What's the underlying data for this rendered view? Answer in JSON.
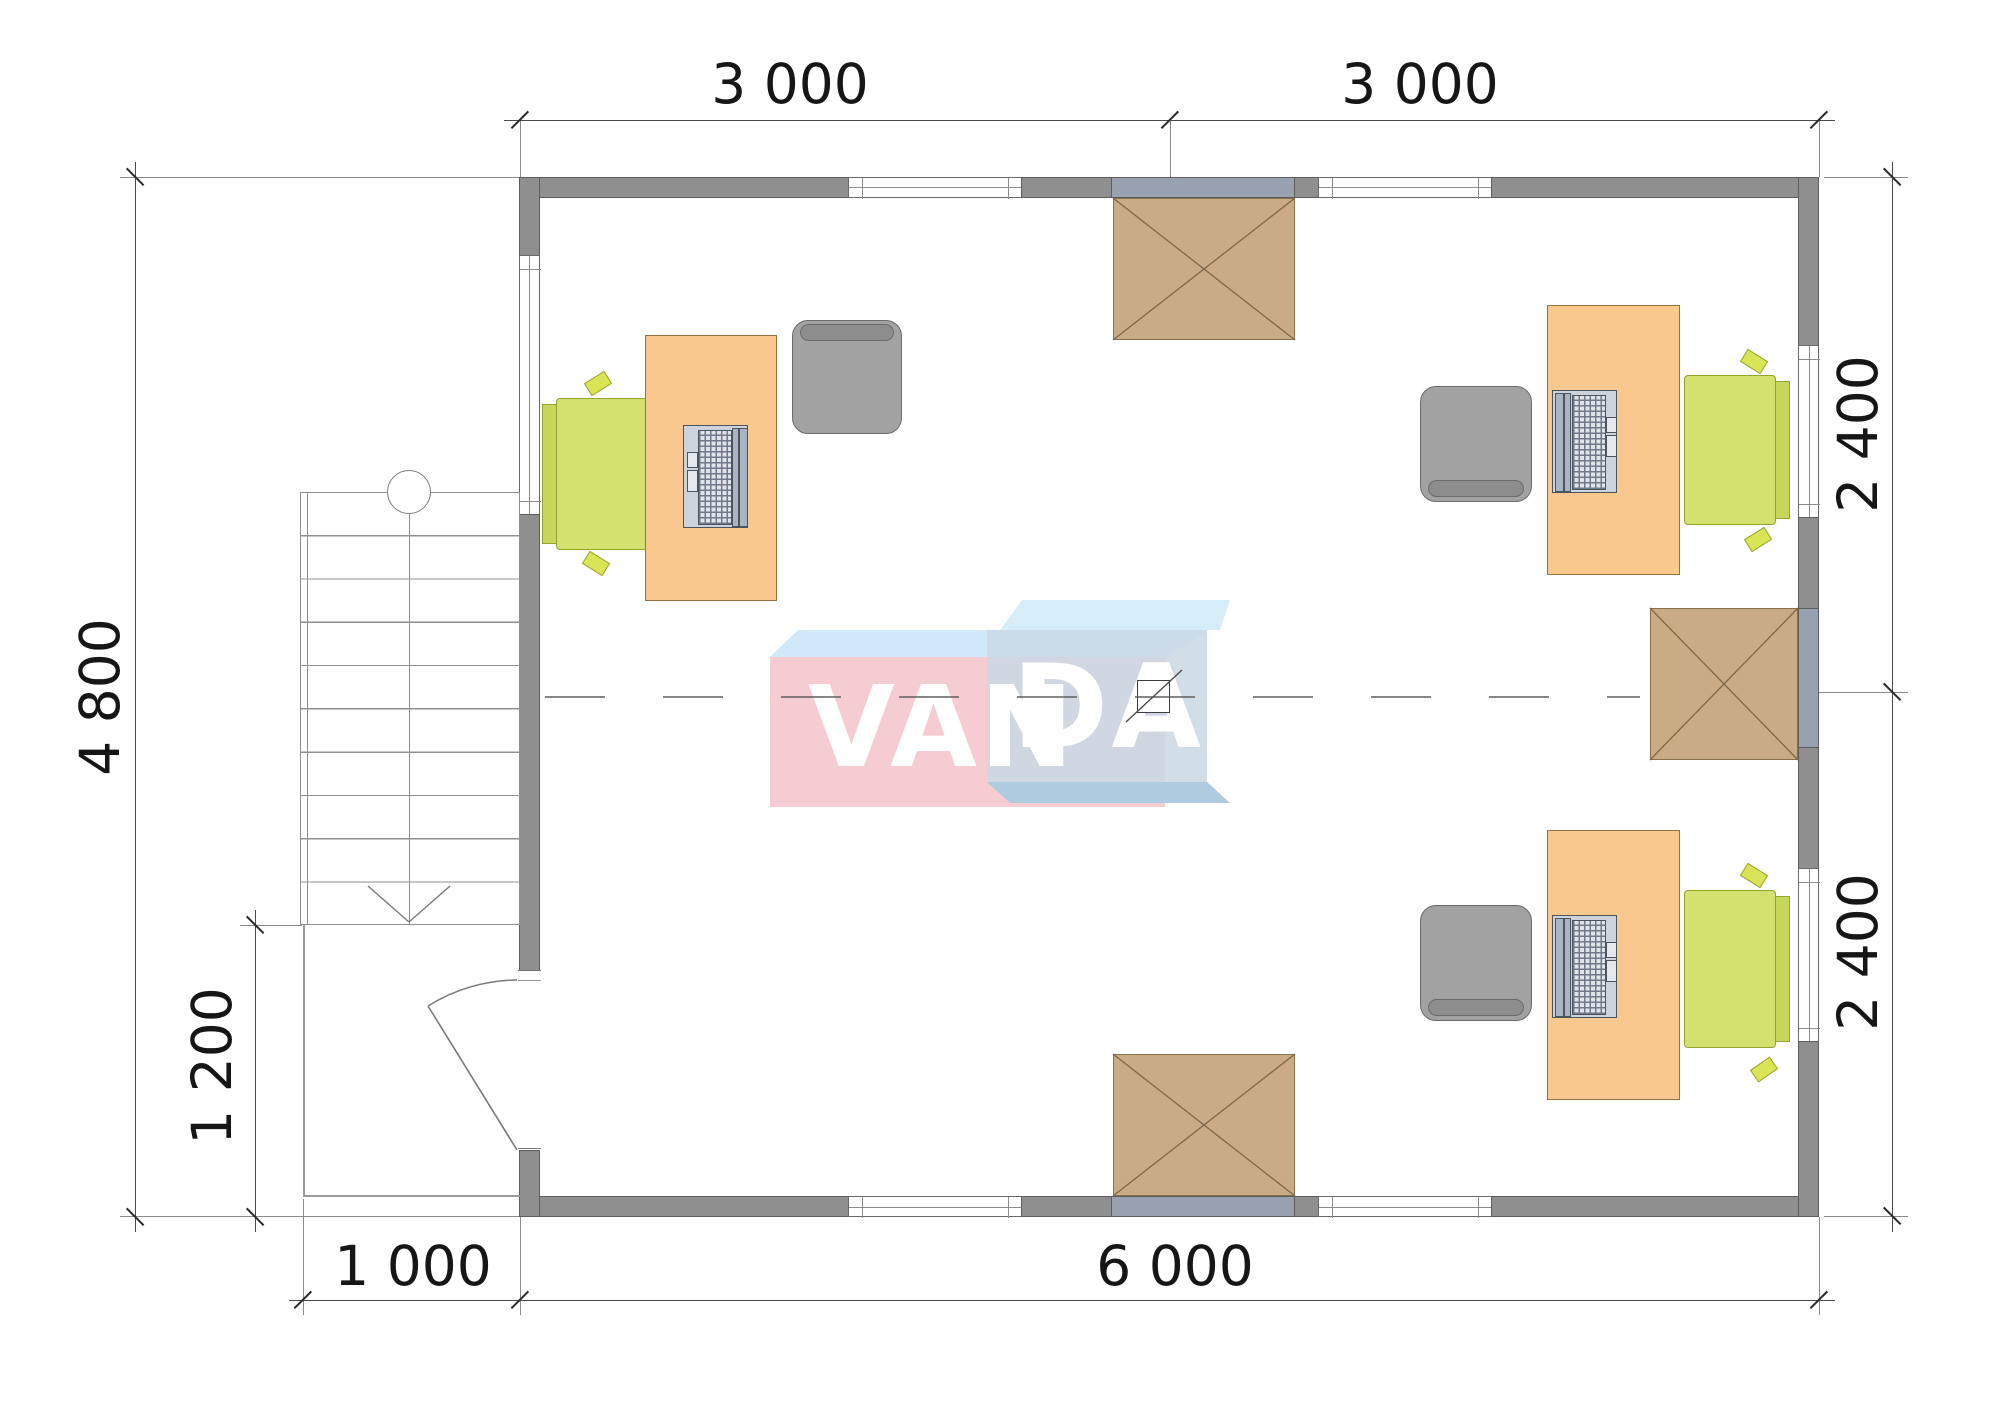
{
  "drawing": {
    "type": "floor-plan",
    "room": "open office with three workstations, external stair and entry porch"
  },
  "dimensions": {
    "top_left_span": "3 000",
    "top_right_span": "3 000",
    "left_height": "4 800",
    "porch_depth": "1 200",
    "porch_width": "1 000",
    "bottom_width": "6 000",
    "right_upper_span": "2 400",
    "right_lower_span": "2 400"
  },
  "logo": {
    "part1": "VAN",
    "part2": "DA"
  },
  "palette": {
    "wall_gray": "#8f8f8f",
    "wall_tint_blue": "#98a1b0",
    "desk_orange": "#f9c88e",
    "chair_gray": "#a2a2a2",
    "chair_green": "#d3e26e",
    "hatch_brown": "#c9ab85",
    "logo_pink": "#f6ccd3",
    "logo_blue": "#cbd8e4",
    "line_dark": "#2b2b2b"
  }
}
